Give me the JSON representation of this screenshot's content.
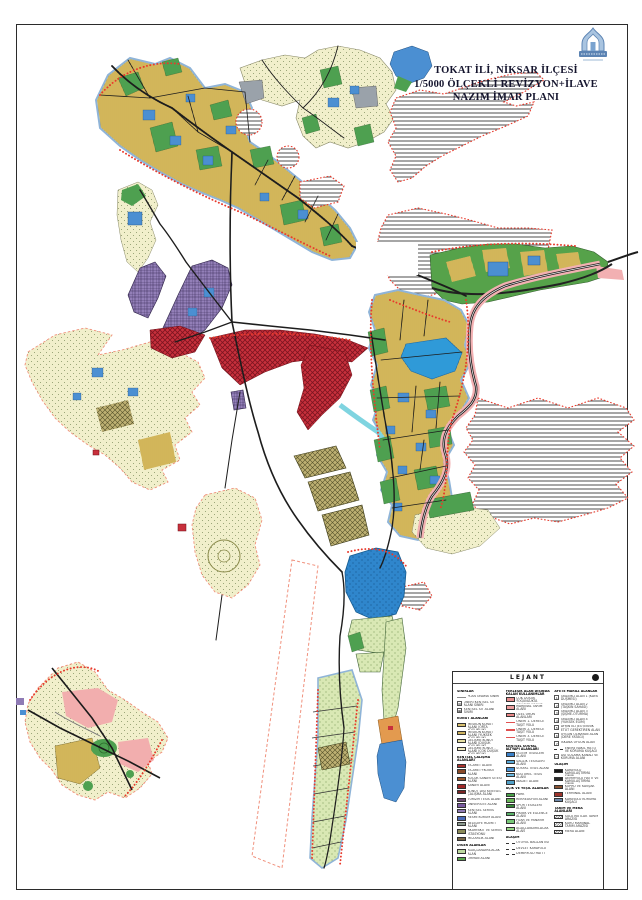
{
  "header": {
    "line1": "TOKAT İLİ, NİKSAR İLÇESİ",
    "line2": "1/5000 ÖLÇEKLİ REVİZYON+İLAVE",
    "line3": "NAZIM İMAR PLANI"
  },
  "map_palette": {
    "residential_yellow": "#e9cf72",
    "development_cream": "#f1efcb",
    "park_green": "#4ea050",
    "facility_blue": "#4b8fd2",
    "commercial_red": "#c8303c",
    "university_purple": "#937fb8",
    "pasture_stripe_gray": "#606060",
    "water_blue": "#2f9ad8",
    "agriculture_olive": "#bdb072",
    "green_dot_area": "#d9e8b4",
    "road_black": "#1d1d1d",
    "corridor_pink": "#f2b0b2",
    "boundary_red": "#e83a2c"
  },
  "legend": {
    "title": "LEJANT",
    "col1": [
      {
        "t": "header",
        "label": "SINIRLAR"
      },
      {
        "t": "line",
        "color": "#8a8a8a",
        "label": "PLAN ONAMA SINIRI"
      },
      {
        "t": "sym",
        "g": "▨",
        "label": "ÖNERİ KENTSEL SİT ALANI SINIRI"
      },
      {
        "t": "sym",
        "g": "▦",
        "label": "KENTSEL SİT ALANI SINIRI"
      },
      {
        "t": "header",
        "label": "KONUT ALANLARI"
      },
      {
        "t": "swatch",
        "color": "#d8c070",
        "label": "MESKUN KONUT ALANI (ORTA YOĞUNLUK)"
      },
      {
        "t": "swatch",
        "color": "#cdb25e",
        "label": "MESKUN KONUT ALANI (YÜKSEK YOĞUNLUK)"
      },
      {
        "t": "swatch",
        "color": "#e6dfa2",
        "label": "GELİŞME KONUT ALANI (DÜŞÜK YOĞUNLUK)"
      },
      {
        "t": "swatch",
        "color": "#efe9bf",
        "label": "GELİŞME KONUT ALANI (ÇOK DÜŞÜK YOĞUNLUK)"
      },
      {
        "t": "header",
        "label": "KENTSEL ÇALIŞMA ALANLARI"
      },
      {
        "t": "swatch",
        "color": "#a8322e",
        "label": "TİCARET ALANI"
      },
      {
        "t": "swatch",
        "color": "#8a4a28",
        "label": "TİCARET+KONUT ALANI"
      },
      {
        "t": "swatch",
        "color": "#9c5a2e",
        "label": "KÜÇÜK SANAYİ SİTESİ ALANI"
      },
      {
        "t": "swatch",
        "color": "#a02828",
        "label": "SANAYİ ALANI"
      },
      {
        "t": "swatch",
        "color": "#7a2424",
        "label": "KONUT DIŞI KENTSEL ÇALIŞMA ALANI"
      },
      {
        "t": "swatch",
        "color": "#6e4a74",
        "label": "TURİZM TESİS ALANI"
      },
      {
        "t": "swatch",
        "color": "#7a5aa0",
        "label": "ÜNİVERSİTE ALANI"
      },
      {
        "t": "swatch",
        "color": "#8f7bb5",
        "label": "KENTSEL SERVİS ALANI"
      },
      {
        "t": "swatch",
        "color": "#4a6ab8",
        "label": "RESMİ KURUM ALANI"
      },
      {
        "t": "swatch",
        "color": "#8a9a8e",
        "label": "BELEDİYE HİZMET ALANI"
      },
      {
        "t": "swatch",
        "color": "#8a8a58",
        "label": "AKARYAKIT VE SERVİS İSTASYONU"
      },
      {
        "t": "swatch",
        "color": "#7a6848",
        "label": "MEZARLIK ALANI"
      },
      {
        "t": "header",
        "label": "DİĞER ALANLAR"
      },
      {
        "t": "swatch",
        "color": "#bcd9a0",
        "label": "AĞAÇLANDIRILACAK ALAN"
      },
      {
        "t": "swatch",
        "color": "#5aa84e",
        "label": "ORMAN ALANI"
      }
    ],
    "col2": [
      {
        "t": "header",
        "label": "YERLEŞİK ALAN DIŞINDA KALAN KULLANIMLAR"
      },
      {
        "t": "swatch",
        "color": "#e89090",
        "label": "ÇOK DÜŞÜK YOĞUNLUKTA GELİŞME KONUT ALANI"
      },
      {
        "t": "swatch",
        "color": "#ee9e9e",
        "label": "MARJİNAL TARIM ALANI"
      },
      {
        "t": "swatch",
        "color": "#e88686",
        "label": "ÖZEL ÜRÜN ALANLARI"
      },
      {
        "t": "line",
        "color": "#e05050",
        "label": "ÖNERİ 1. DERECE TAŞIT YOLU"
      },
      {
        "t": "line",
        "color": "#e05050",
        "label": "ÖNERİ 2. DERECE TAŞIT YOLU"
      },
      {
        "t": "line",
        "color": "#e05050",
        "label": "ÖNERİ 3. DERECE TAŞIT YOLU"
      },
      {
        "t": "header",
        "label": "KENTSEL SOSYAL ALTYAPI ALANLARI"
      },
      {
        "t": "swatch",
        "color": "#3a80c8",
        "label": "EĞİTİM TESİSLERİ ALANI"
      },
      {
        "t": "swatch",
        "color": "#58a8d8",
        "label": "SAĞLIK TESİSLERİ ALANI"
      },
      {
        "t": "swatch",
        "color": "#4890d0",
        "label": "SOSYAL TESİS ALANI"
      },
      {
        "t": "swatch",
        "color": "#68b8e0",
        "label": "KÜLTÜREL TESİS ALANI"
      },
      {
        "t": "swatch",
        "color": "#50a0c8",
        "label": "İBADET ALANI"
      },
      {
        "t": "header",
        "label": "AÇIK VE YEŞİL ALANLAR"
      },
      {
        "t": "swatch",
        "color": "#48a048",
        "label": "PARK"
      },
      {
        "t": "swatch",
        "color": "#68b858",
        "label": "REKREASYON ALANI"
      },
      {
        "t": "swatch",
        "color": "#388838",
        "label": "SPOR TESİSLERİ ALANI"
      },
      {
        "t": "swatch",
        "color": "#58b068",
        "label": "PİKNİK VE EĞLENCE ALANI"
      },
      {
        "t": "swatch",
        "color": "#78c878",
        "label": "FUAR VE PANAYIR ALANI"
      },
      {
        "t": "swatch",
        "color": "#98d888",
        "label": "AĞAÇLANDIRILACAK ALAN"
      },
      {
        "t": "header",
        "label": "ULAŞIM"
      },
      {
        "t": "dash",
        "label": "OTOYOL BAĞLANTISI"
      },
      {
        "t": "dash",
        "label": "DEVLET KARAYOLU"
      },
      {
        "t": "dash",
        "label": "DEMİRYOLU HATTI"
      }
    ],
    "col3": [
      {
        "t": "header",
        "label": "AFETE MARUZ ALANLAR"
      },
      {
        "t": "sym",
        "g": "1",
        "label": "ÖNLEMLİ ALAN 1 (KAYA DÜŞMESİ)"
      },
      {
        "t": "sym",
        "g": "2",
        "label": "ÖNLEMLİ ALAN 2 (TAŞKIN SAHASI)"
      },
      {
        "t": "sym",
        "g": "3",
        "label": "ÖNLEMLİ ALAN 3 (ŞİŞME-OTURMA)"
      },
      {
        "t": "sym",
        "g": "4",
        "label": "ÖNLEMLİ ALAN 4 (YÜKSEK EĞİM)"
      },
      {
        "t": "sym",
        "g": "5",
        "label": "AYRINTILI JEOTEKNİK ETÜT GEREKTİREN ALAN"
      },
      {
        "t": "sym",
        "g": "6",
        "label": "UYGUN OLMAYAN ALAN (DERE YATAĞI)"
      },
      {
        "t": "sym",
        "g": "7",
        "label": "İSKANA UYGUN ALAN"
      },
      {
        "t": "dash",
        "label": "ENERJİ NAKİL HATTI VE KORUMA KUŞAĞI"
      },
      {
        "t": "sym",
        "g": "□",
        "label": "DSİ SULAMA KANALI VE KORUMA ALANI"
      },
      {
        "t": "header",
        "label": "ULAŞIM"
      },
      {
        "t": "swatch",
        "color": "#151515",
        "label": "KARAYOLU KAMULAŞTIRMA SINIRI"
      },
      {
        "t": "swatch",
        "color": "#2a2a2a",
        "label": "DEMİRYOLU HATTI VE KAMULAŞTIRMA SINIRI"
      },
      {
        "t": "swatch",
        "color": "#8a5434",
        "label": "KÖPRÜ VE KAVŞAK ALANI"
      },
      {
        "t": "swatch",
        "color": "#9e342c",
        "label": "TERMİNAL ALANI"
      },
      {
        "t": "swatch",
        "color": "#6d88aa",
        "label": "KARAYOLU KORUMA KUŞAĞI"
      },
      {
        "t": "header",
        "label": "TARIM VE MERA ALANLARI"
      },
      {
        "t": "hatch",
        "label": "SULU MUTLAK TARIM ARAZİSİ"
      },
      {
        "t": "hatch",
        "label": "KURU MARJİNAL TARIM ARAZİSİ"
      },
      {
        "t": "hatch",
        "label": "MERA ALANI"
      }
    ]
  }
}
